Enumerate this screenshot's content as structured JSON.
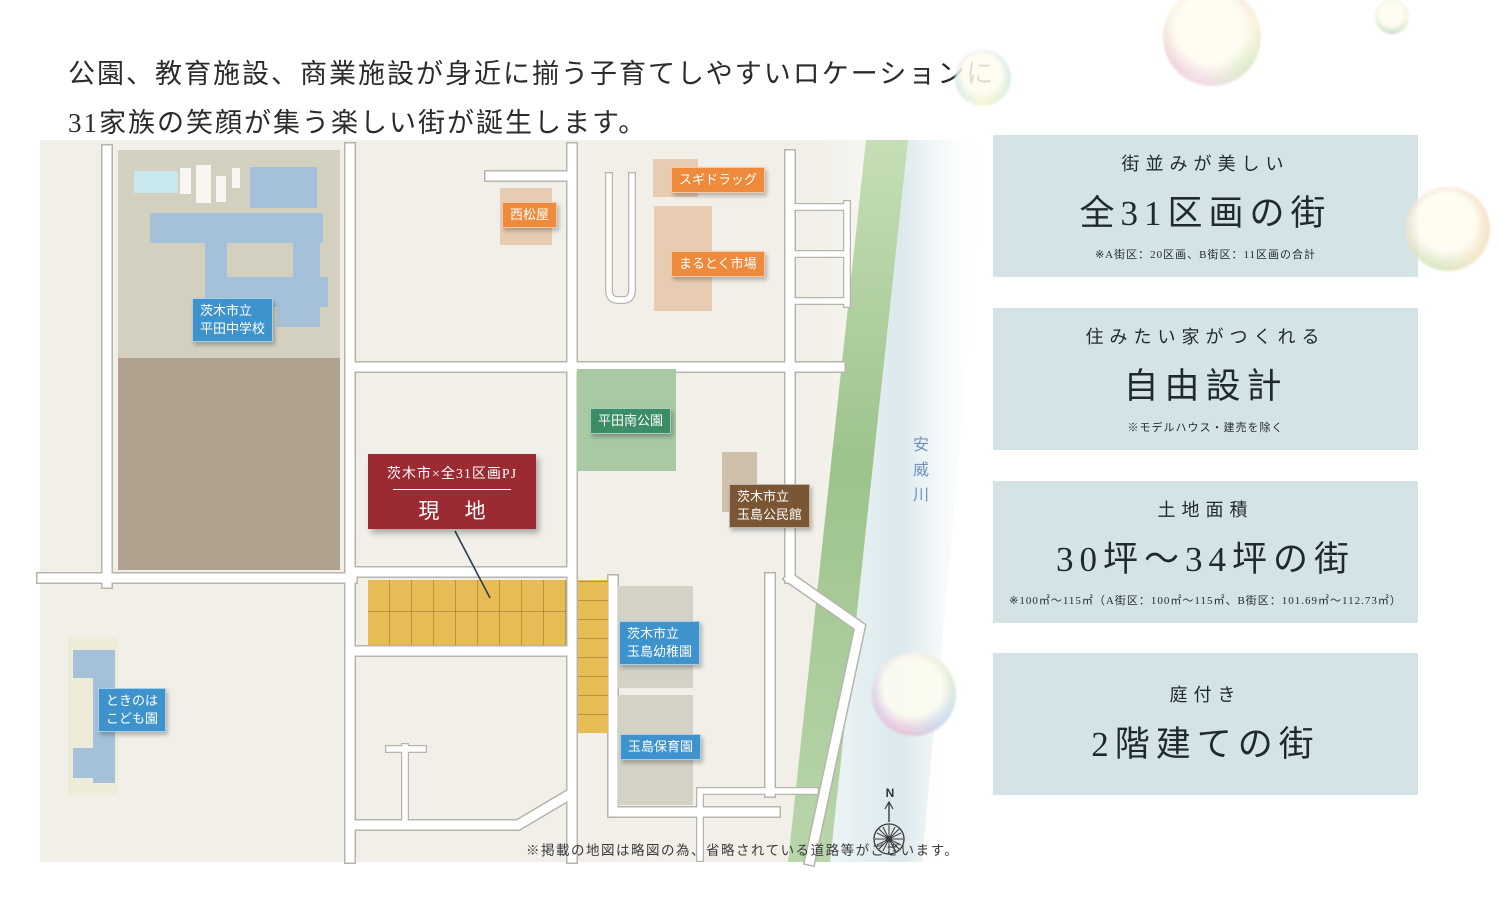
{
  "headline": {
    "line1": "公園、教育施設、商業施設が身近に揃う子育てしやすいロケーションに",
    "line2": "31家族の笑顔が集う楽しい街が誕生します。"
  },
  "map": {
    "labels": {
      "school": "茨木市立\n平田中学校",
      "nishimatsuya": "西松屋",
      "sugi_drug": "スギドラッグ",
      "marutoku_market": "まるとく市場",
      "hirata_minami_park": "平田南公園",
      "tamashima_kominkan": "茨木市立\n玉島公民館",
      "tamashima_yochien": "茨木市立\n玉島幼稚園",
      "tamashima_hoikuen": "玉島保育園",
      "tokinoha_kodomoen": "ときのは\nこども園",
      "river": "安威川",
      "compass_north": "N"
    },
    "site_box": {
      "title": "茨木市×全31区画PJ",
      "label": "現 地"
    },
    "note": "※掲載の地図は略図の為、省略されている道路等がございます。"
  },
  "features": [
    {
      "sub": "街並みが美しい",
      "main": "全31区画の街",
      "note": "※A街区：20区画、B街区：11区画の合計"
    },
    {
      "sub": "住みたい家がつくれる",
      "main": "自由設計",
      "note": "※モデルハウス・建売を除く"
    },
    {
      "sub": "土地面積",
      "main": "30坪〜34坪の街",
      "note": "※100㎡〜115㎡（A街区：100㎡〜115㎡、B街区：101.69㎡〜112.73㎡）"
    },
    {
      "sub": "庭付き",
      "main": "2階建ての街",
      "note": ""
    }
  ],
  "colors": {
    "site_red": "#9c2a33",
    "label_blue": "#3e93cc",
    "label_orange": "#ed8a3c",
    "label_green": "#3b8d66",
    "label_brown": "#7a5634",
    "parcel_yellow": "#e8bc54",
    "park_green": "#a9c8a4",
    "riverbank_green": "#a6c898",
    "feature_box_bg": "#d4e3e6"
  }
}
